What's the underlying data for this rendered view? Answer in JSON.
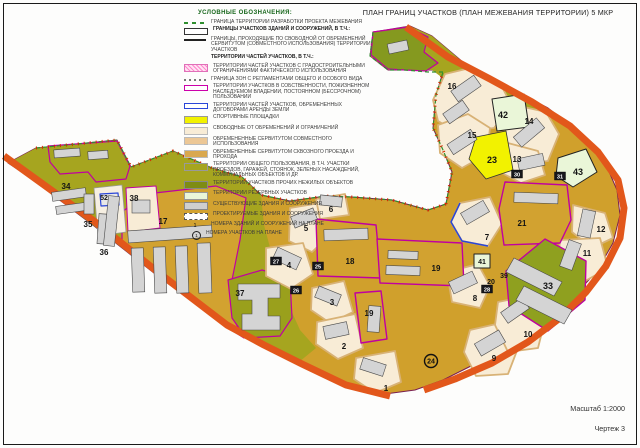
{
  "title": "ПЛАН ГРАНИЦ УЧАСТКОВ (ПЛАН МЕЖЕВАНИЯ ТЕРРИТОРИИ) 5 МКР",
  "footer": {
    "scale": "Масштаб 1:2000",
    "sheet": "Чертеж 3"
  },
  "legend": {
    "header": "УСЛОВНЫЕ ОБОЗНАЧЕНИЯ:",
    "items": [
      {
        "sym": "dashgreen",
        "label": "ГРАНИЦА ТЕРРИТОРИИ РАЗРАБОТКИ ПРОЕКТА МЕЖЕВАНИЯ"
      },
      {
        "sym": "rectoutline",
        "bold": true,
        "label": "ГРАНИЦЫ УЧАСТКОВ ЗДАНИЙ И СООРУЖЕНИЙ, В Т.Ч.:"
      },
      {
        "sym": "linesolid",
        "label": "ГРАНИЦЫ, ПРОХОДЯЩИЕ ПО СВОБОДНОЙ ОТ ОБРЕМЕНЕНИЙ СЕРВИТУТОМ (СОВМЕСТНОГО ИСПОЛЬЗОВАНИЯ) ТЕРРИТОРИИ УЧАСТКОВ"
      },
      {
        "sym": "none",
        "bold": true,
        "label": "ТЕРРИТОРИИ ЧАСТЕЙ УЧАСТКОВ, В Т.Ч.:"
      },
      {
        "sym": "hatchpink",
        "label": "ТЕРРИТОРИИ ЧАСТЕЙ УЧАСТКОВ С ГРАДОСТРОИТЕЛЬНЫМИ ОГРАНИЧЕНИЯМИ ФАКТИЧЕСКОГО ИСПОЛЬЗОВАНИЯ"
      },
      {
        "sym": "dashshort",
        "label": "ГРАНИЦА ЗОН С РЕГЛАМЕНТАМИ ОБЩЕГО И ОСОБОГО ВИДА"
      },
      {
        "sym": "rectmagenta",
        "label": "ТЕРРИТОРИИ УЧАСТКОВ В СОБСТВЕННОСТИ, ПОЖИЗНЕННОМ НАСЛЕДУЕМОМ ВЛАДЕНИИ, ПОСТОЯННОМ (БЕССРОЧНОМ) ПОЛЬЗОВАНИИ"
      },
      {
        "sym": "rectblue",
        "label": "ТЕРРИТОРИИ ЧАСТЕЙ УЧАСТКОВ, ОБРЕМЕНЕННЫХ ДОГОВОРАМИ АРЕНДЫ ЗЕМЛИ"
      },
      {
        "sym": "fyellow",
        "label": "СПОРТИВНЫЕ ПЛОЩАДКИ"
      },
      {
        "sym": "fcream",
        "label": "СВОБОДНЫЕ ОТ ОБРЕМЕНЕНИЙ И ОГРАНИЧЕНИЙ"
      },
      {
        "sym": "ftan",
        "label": "ОБРЕМЕНЕННЫЕ СЕРВИТУТОМ СОВМЕСТНОГО ИСПОЛЬЗОВАНИЯ"
      },
      {
        "sym": "ftan2",
        "label": "ОБРЕМЕНЕННЫЕ СЕРВИТУТОМ СКВОЗНОГО ПРОЕЗДА И ПРОХОДА"
      },
      {
        "sym": "folive",
        "label": "ТЕРРИТОРИИ ОБЩЕГО ПОЛЬЗОВАНИЯ, В Т.Ч. УЧАСТКИ ПРОЕЗДОВ, ГАРАЖЕЙ, СТОЯНОК, ЗЕЛЕНЫХ НАСАЖДЕНИЙ, КОММУНАЛЬНЫХ ОБЪЕКТОВ И ДР."
      },
      {
        "sym": "fdolive",
        "label": "ТЕРРИТОРИИ УЧАСТКОВ ПРОЧИХ НЕЖИЛЫХ ОБЪЕКТОВ"
      },
      {
        "sym": "fpgreen",
        "label": "ТЕРРИТОРИИ РЕЗЕРВНЫХ УЧАСТКОВ"
      },
      {
        "sym": "fgray",
        "label": "СУЩЕСТВУЮЩИЕ ЗДАНИЯ И СООРУЖЕНИЯ"
      },
      {
        "sym": "rectdashed",
        "label": "ПРОЕКТИРУЕМЫЕ ЗДАНИЯ И СООРУЖЕНИЯ"
      },
      {
        "sym": "num",
        "mark": "1",
        "label": "НОМЕРА ЗДАНИЙ И СООРУЖЕНИЙ НА ПЛАНЕ"
      },
      {
        "sym": "numcirc",
        "mark": "1",
        "label": "НОМЕРА УЧАСТКОВ НА ПЛАНЕ"
      }
    ]
  },
  "colors": {
    "mustard": "#d0a02c",
    "olive": "#a6a51f",
    "green_parcel": "#85991f",
    "green_33": "#8fa01f",
    "cream": "#f8ecd6",
    "cream_ring": "#d8b276",
    "yellow": "#f2f200",
    "pale_green": "#eaf6d8",
    "road": "#e2571b",
    "magenta": "#c000a0",
    "boundary_green": "#2f8f2f",
    "boundary_red": "#d42b00",
    "building": "#d4d4d4",
    "building_edge": "#4a4a4a",
    "blue": "#2a46d8",
    "outline_dark": "#7a1f4f"
  },
  "map": {
    "regions": [
      {
        "n": "territory-base",
        "f": "#d0a02c",
        "s": "#7a1f4f",
        "w": 1,
        "p": "8,163 36,148 117,140 131,167 173,151 212,168 242,177 261,195 290,201 326,196 352,197 392,200 428,210 446,204 452,172 443,150 433,128 436,95 443,72 432,70 405,70 388,70 370,56 373,32 410,26 432,36 470,68 510,88 548,108 582,134 604,160 617,190 620,215 613,243 597,271 575,295 547,319 513,342 477,363 443,380 415,390 385,394 342,382 299,362 261,344 227,327 159,277 94,226 29,177"
      },
      {
        "n": "olive-left-cluster",
        "f": "#a6a51f",
        "p": "8,163 36,148 117,140 131,167 173,151 212,168 242,177 261,195 264,225 272,255 282,290 300,330 316,348 299,362 261,344 227,327 159,277 94,226 29,177"
      },
      {
        "n": "olive-north-band",
        "f": "#a6a51f",
        "p": "373,32 410,26 432,36 470,68 510,88 545,107 528,120 488,100 452,85 432,70 405,70 388,70 370,56"
      },
      {
        "n": "parcel-green-top",
        "f": "#85991f",
        "s": "#c000a0",
        "w": 1.2,
        "p": "373,32 408,27 428,37 424,52 438,63 426,71 405,70 388,69 371,55"
      },
      {
        "n": "parcel-17",
        "f": "#d2a230",
        "s": "#c000a0",
        "w": 1.2,
        "p": "122,212 146,194 216,186 246,198 240,240 232,280 234,320 244,338 228,328 186,296 148,266 122,242"
      },
      {
        "n": "parcel-37",
        "f": "#9aa01c",
        "s": "#c000a0",
        "w": 1.2,
        "p": "228,280 262,270 290,278 292,318 280,336 246,338 232,318"
      },
      {
        "n": "parcel-topleft-magenta",
        "f": "#a6a51f",
        "s": "#c000a0",
        "w": 1.2,
        "p": "48,146 117,141 130,166 126,179 96,182 88,172 60,174 50,162"
      },
      {
        "n": "lot-52",
        "f": "#f6efe2",
        "s": "#999999",
        "w": 0.8,
        "p": "94,188 122,185 126,232 98,236"
      },
      {
        "n": "lot-38",
        "f": "#f8ecd6",
        "s": "#c000a0",
        "w": 1,
        "p": "126,188 156,186 160,228 128,232"
      },
      {
        "n": "lot-16",
        "f": "#f8ecd6",
        "s": "#d8b276",
        "w": 1.8,
        "p": "433,100 445,74 466,69 502,87 512,106 494,128 458,133 438,121"
      },
      {
        "n": "lot-15",
        "f": "#f8ecd6",
        "s": "#d8b276",
        "w": 1.8,
        "p": "438,125 468,114 490,128 487,154 462,168 440,153"
      },
      {
        "n": "lot-14",
        "f": "#f8ecd6",
        "s": "#d8b276",
        "w": 1.8,
        "p": "506,103 546,112 559,134 548,161 520,165 505,141"
      },
      {
        "n": "lot-13",
        "f": "#f8ecd6",
        "s": "#d8b276",
        "w": 1.8,
        "p": "504,142 538,151 545,175 521,183 500,172"
      },
      {
        "n": "lot-12",
        "f": "#f8ecd6",
        "s": "#d8b276",
        "w": 1.8,
        "p": "573,205 605,213 613,238 592,248 572,232"
      },
      {
        "n": "lot-11",
        "f": "#f8ecd6",
        "s": "#d8b276",
        "w": 1.8,
        "p": "560,240 600,238 608,268 580,284 558,266"
      },
      {
        "n": "lot-7",
        "f": "#f8ecd6",
        "s": "#d8b276",
        "w": 1.8,
        "p": "460,203 490,197 502,224 488,246 462,241 451,222"
      },
      {
        "n": "lot-8",
        "f": "#f8ecd6",
        "s": "#d8b276",
        "w": 1.8,
        "p": "447,272 478,264 490,286 480,308 452,302"
      },
      {
        "n": "lot-9",
        "f": "#f8ecd6",
        "s": "#d8b276",
        "w": 1.8,
        "p": "470,330 505,322 518,348 508,374 476,376 464,352"
      },
      {
        "n": "lot-10",
        "f": "#f8ecd6",
        "s": "#d8b276",
        "w": 1.8,
        "p": "498,302 532,295 545,320 538,348 508,352 495,325"
      },
      {
        "n": "lot-5",
        "f": "#f8ecd6",
        "s": "#d8b276",
        "w": 1.8,
        "p": "290,208 320,203 331,234 312,252 289,241"
      },
      {
        "n": "lot-4",
        "f": "#f8ecd6",
        "s": "#d8b276",
        "w": 1.8,
        "p": "266,248 303,243 313,274 291,289 266,276"
      },
      {
        "n": "lot-6",
        "f": "#f8ecd6",
        "s": "#d8b276",
        "w": 1.8,
        "p": "316,199 345,194 349,215 320,219"
      },
      {
        "n": "lot-3",
        "f": "#f8ecd6",
        "s": "#d8b276",
        "w": 1.8,
        "p": "312,288 344,281 353,312 330,323 311,310"
      },
      {
        "n": "lot-2",
        "f": "#f8ecd6",
        "s": "#d8b276",
        "w": 1.8,
        "p": "317,322 355,314 363,348 338,359 316,344"
      },
      {
        "n": "lot-1",
        "f": "#f8ecd6",
        "s": "#d8b276",
        "w": 1.8,
        "p": "356,358 395,351 401,382 375,393 354,379"
      },
      {
        "n": "parcel-18",
        "f": "#d2a230",
        "s": "#c000a0",
        "w": 1.4,
        "p": "316,219 376,225 381,278 318,276"
      },
      {
        "n": "parcel-19a",
        "f": "#d2a230",
        "s": "#c000a0",
        "w": 1.4,
        "p": "377,239 462,243 464,286 380,283"
      },
      {
        "n": "parcel-19b",
        "f": "#d2a230",
        "s": "#c000a0",
        "w": 1.4,
        "p": "355,293 381,291 387,339 361,343"
      },
      {
        "n": "parcel-21",
        "f": "#d2a230",
        "s": "#c000a0",
        "w": 1.4,
        "p": "505,182 567,185 571,220 560,243 504,245 499,209"
      },
      {
        "n": "parcel-33",
        "f": "#8fa01f",
        "s": "#c000a0",
        "w": 1.4,
        "p": "506,271 545,239 586,261 585,300 548,331 509,306"
      },
      {
        "n": "parcel-23-sports",
        "f": "#f2f200",
        "s": "#333333",
        "w": 0.8,
        "p": "476,137 506,131 513,170 486,179 469,159"
      },
      {
        "n": "parcel-42-reserve",
        "f": "#eaf6d8",
        "s": "#222222",
        "w": 1,
        "p": "492,99 524,94 529,127 497,131"
      },
      {
        "n": "parcel-43-reserve",
        "f": "#eaf6d8",
        "s": "#222222",
        "w": 1,
        "p": "558,158 586,149 597,172 573,187 556,176"
      },
      {
        "n": "parcel-41-reserve",
        "f": "#eaf6d8",
        "s": "#222222",
        "w": 1,
        "p": "474,254 490,254 490,268 474,268"
      },
      {
        "n": "building-blue-lease",
        "f": "#e8e8e8",
        "s": "#2a46d8",
        "w": 1.2,
        "p": "100,194 118,193 119,205 101,206"
      }
    ],
    "lines": [
      {
        "n": "road-southwest",
        "p": "4,156 94,221 159,273 227,325 264,345 302,364 346,385 390,396",
        "s": "#e2571b",
        "w": 7
      },
      {
        "n": "road-northeast-arc",
        "p": "406,27 448,57 490,79 532,102 570,126 598,152 618,180 624,208 620,238 606,266 586,292 560,318 528,342 492,363 455,379 424,390",
        "s": "#e2571b",
        "w": 7
      },
      {
        "n": "boundary-top-green-dash",
        "p": "36,148 117,140 131,167 173,151 212,168 242,177 261,195 290,201 326,196 352,197 392,200 428,210 446,204",
        "s": "#2f8f2f",
        "w": 1.2,
        "d": "4,3"
      },
      {
        "n": "boundary-top-red-ticks",
        "p": "36,148 117,140 131,167 173,151 212,168 242,177 261,195 290,201 326,196 352,197 392,200 428,210 446,204",
        "s": "#d42b00",
        "w": 3,
        "d": "1,5"
      },
      {
        "n": "boundary-west16-green-dash",
        "p": "446,204 452,172 443,150 433,128 436,95 443,72",
        "s": "#2f8f2f",
        "w": 1.2,
        "d": "4,3"
      },
      {
        "n": "boundary-west16-red-ticks",
        "p": "446,204 452,172 443,150 433,128 436,95 443,72",
        "s": "#d42b00",
        "w": 3,
        "d": "1,5"
      },
      {
        "n": "boundary-greenparcel-dash",
        "p": "443,72 428,72 405,70 388,70 370,56 373,32",
        "s": "#2f8f2f",
        "w": 1.2,
        "d": "4,3"
      },
      {
        "n": "lease-outline-lot7",
        "p": "460,203 451,222 462,241 488,246",
        "s": "#2a46d8",
        "w": 1.5
      }
    ],
    "buildings": [
      [
        128,
        228,
        84,
        12,
        -4
      ],
      [
        132,
        248,
        12,
        44,
        -2
      ],
      [
        154,
        247,
        12,
        46,
        -2
      ],
      [
        176,
        246,
        12,
        47,
        -2
      ],
      [
        198,
        243,
        13,
        50,
        -2
      ],
      [
        52,
        190,
        34,
        9,
        -8
      ],
      [
        56,
        204,
        36,
        8,
        -8
      ],
      [
        84,
        194,
        10,
        20,
        0
      ],
      [
        98,
        214,
        12,
        30,
        4
      ],
      [
        106,
        196,
        11,
        50,
        6
      ],
      [
        132,
        200,
        18,
        13,
        0
      ],
      [
        54,
        149,
        26,
        8,
        -4
      ],
      [
        88,
        151,
        20,
        8,
        -4
      ],
      [
        388,
        42,
        20,
        10,
        -12
      ],
      [
        452,
        82,
        28,
        13,
        -35
      ],
      [
        444,
        106,
        24,
        12,
        -35
      ],
      [
        448,
        136,
        28,
        12,
        -33
      ],
      [
        514,
        126,
        30,
        13,
        -40
      ],
      [
        518,
        156,
        26,
        12,
        -12
      ],
      [
        580,
        210,
        13,
        27,
        12
      ],
      [
        564,
        241,
        13,
        28,
        20
      ],
      [
        462,
        206,
        26,
        13,
        -30
      ],
      [
        514,
        193,
        44,
        10,
        2
      ],
      [
        388,
        251,
        30,
        8,
        2
      ],
      [
        386,
        266,
        34,
        9,
        2
      ],
      [
        324,
        229,
        44,
        11,
        -2
      ],
      [
        450,
        276,
        26,
        13,
        -25
      ],
      [
        476,
        336,
        28,
        14,
        -30
      ],
      [
        502,
        304,
        26,
        13,
        -35
      ],
      [
        292,
        212,
        24,
        12,
        -22
      ],
      [
        274,
        252,
        26,
        13,
        25
      ],
      [
        320,
        196,
        22,
        10,
        6
      ],
      [
        316,
        290,
        24,
        12,
        22
      ],
      [
        324,
        324,
        24,
        13,
        -12
      ],
      [
        361,
        361,
        24,
        12,
        18
      ],
      [
        368,
        306,
        12,
        26,
        4
      ]
    ],
    "building_polys": [
      {
        "n": "building-school-37",
        "p": "238,284 280,284 280,298 268,298 268,316 280,316 280,330 242,330 242,314 252,314 252,300 238,300"
      },
      {
        "n": "building-33-a",
        "p": "514,258 562,282 554,296 506,272"
      },
      {
        "n": "building-33-b",
        "p": "524,286 572,310 564,324 516,300"
      }
    ],
    "parcel_labels": [
      [
        "34",
        66,
        189
      ],
      [
        "35",
        88,
        227
      ],
      [
        "52",
        104,
        200,
        7
      ],
      [
        "38",
        134,
        201
      ],
      [
        "17",
        163,
        224
      ],
      [
        "36",
        104,
        255
      ],
      [
        "37",
        240,
        296
      ],
      [
        "5",
        306,
        231
      ],
      [
        "6",
        331,
        212
      ],
      [
        "4",
        289,
        268
      ],
      [
        "18",
        350,
        264
      ],
      [
        "19",
        436,
        271
      ],
      [
        "19",
        369,
        316
      ],
      [
        "3",
        332,
        305
      ],
      [
        "2",
        344,
        349
      ],
      [
        "1",
        386,
        391
      ],
      [
        "16",
        452,
        89
      ],
      [
        "42",
        503,
        118,
        9
      ],
      [
        "14",
        529,
        124
      ],
      [
        "15",
        472,
        138
      ],
      [
        "23",
        492,
        163,
        9
      ],
      [
        "13",
        517,
        162
      ],
      [
        "43",
        578,
        175,
        9
      ],
      [
        "7",
        487,
        240
      ],
      [
        "21",
        522,
        226
      ],
      [
        "12",
        601,
        232
      ],
      [
        "11",
        587,
        256
      ],
      [
        "39",
        504,
        278,
        7
      ],
      [
        "20",
        491,
        284,
        7
      ],
      [
        "8",
        475,
        301
      ],
      [
        "33",
        548,
        289,
        9
      ],
      [
        "9",
        494,
        361
      ],
      [
        "10",
        528,
        337
      ],
      [
        "41",
        482,
        264,
        7
      ]
    ],
    "boxed_labels": [
      [
        "30",
        517,
        175
      ],
      [
        "31",
        560,
        177
      ],
      [
        "27",
        276,
        262
      ],
      [
        "25",
        318,
        267
      ],
      [
        "26",
        296,
        291
      ],
      [
        "28",
        487,
        290
      ]
    ],
    "circled_labels": [
      [
        "24",
        431,
        361
      ]
    ]
  }
}
